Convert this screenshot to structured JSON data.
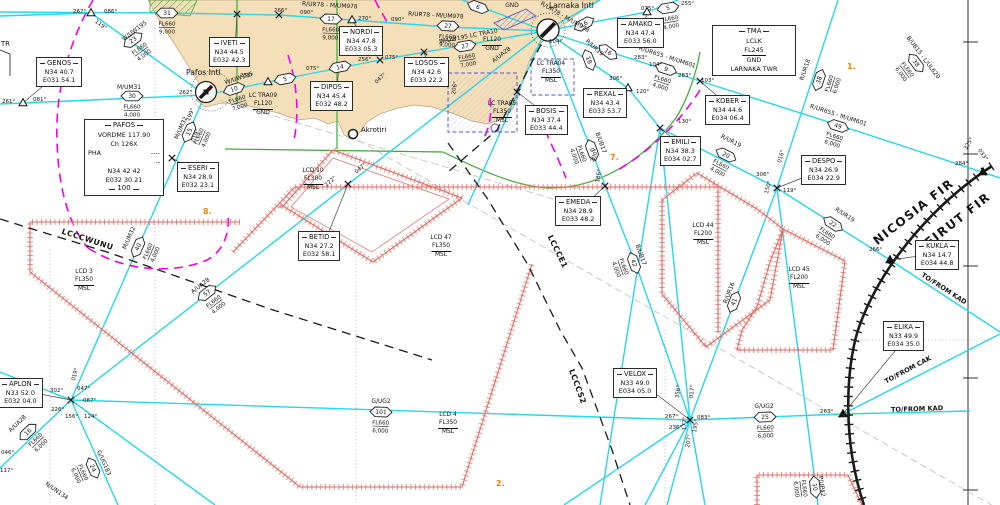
{
  "colors": {
    "cyan": "#27d7e8",
    "land": "#f4dfb9",
    "green": "#3aaa35",
    "red": "#e87c74",
    "magenta": "#f000f0",
    "blue": "#5555cc",
    "orange": "#f5820a",
    "black": "#1a1a1a"
  },
  "fir": [
    {
      "t": "NICOSIA  FIR",
      "x": 916,
      "y": 215,
      "r": -38
    },
    {
      "t": "BEIRUT  FIR",
      "x": 956,
      "y": 226,
      "r": -38
    }
  ],
  "airports": {
    "larnaka": {
      "label": "Larnaka Intl"
    },
    "pafos": {
      "label": "Pafos Intl"
    }
  },
  "town": {
    "label": "Akrotiri"
  },
  "partial_label": "TR",
  "notes": [
    {
      "t": "1.",
      "x": 847,
      "y": 62
    },
    {
      "t": "7.",
      "x": 610,
      "y": 153
    },
    {
      "t": "8.",
      "x": 203,
      "y": 207
    },
    {
      "t": "2.",
      "x": 496,
      "y": 479
    }
  ],
  "waypoints": [
    {
      "name": "GENOS",
      "lat": "N34 40.7",
      "lon": "E031 54.1",
      "bx": 36,
      "by": 57,
      "fx": 23,
      "fy": 103,
      "sym": "tri"
    },
    {
      "name": "IVETI",
      "lat": "N34 44.5",
      "lon": "E032 42.3",
      "bx": 209,
      "by": 37,
      "fx": 237,
      "fy": 14,
      "sym": "x"
    },
    {
      "name": "NORDI",
      "lat": "N34 47.8",
      "lon": "E033 05.3",
      "bx": 339,
      "by": 26,
      "fx": 352,
      "fy": 20,
      "sym": "tri"
    },
    {
      "name": "LOSOS",
      "lat": "N34 42.6",
      "lon": "E033 22.2",
      "bx": 404,
      "by": 57,
      "fx": 424,
      "fy": 52,
      "sym": "x"
    },
    {
      "name": "DIPOS",
      "lat": "N34 45.4",
      "lon": "E032 48.2",
      "bx": 310,
      "by": 81,
      "fx": 339,
      "fy": 68,
      "sym": "x"
    },
    {
      "name": "AMAKO",
      "lat": "N34 47.4",
      "lon": "E033 56.0",
      "bx": 617,
      "by": 18,
      "fx": 647,
      "fy": 12,
      "sym": "tri"
    },
    {
      "name": "REXAL",
      "lat": "N34 43.4",
      "lon": "E033 53.7",
      "bx": 583,
      "by": 88,
      "fx": 628,
      "fy": 88,
      "sym": "tri"
    },
    {
      "name": "BOSIS",
      "lat": "N34 37.4",
      "lon": "E033 44.4",
      "bx": 525,
      "by": 105,
      "fx": 517,
      "fy": 92,
      "sym": "x"
    },
    {
      "name": "KOBER",
      "lat": "N34 44.6",
      "lon": "E034 06.4",
      "bx": 705,
      "by": 95,
      "fx": 700,
      "fy": 81,
      "sym": "x"
    },
    {
      "name": "EMILI",
      "lat": "N34 38.3",
      "lon": "E034 02.7",
      "bx": 660,
      "by": 136,
      "fx": 660,
      "fy": 128,
      "sym": "x"
    },
    {
      "name": "DESPO",
      "lat": "N34 26.9",
      "lon": "E034 22.9",
      "bx": 801,
      "by": 155,
      "fx": 777,
      "fy": 188,
      "sym": "x"
    },
    {
      "name": "EMEDA",
      "lat": "N34 28.9",
      "lon": "E033 48.2",
      "bx": 555,
      "by": 196,
      "fx": 605,
      "fy": 186,
      "sym": "x"
    },
    {
      "name": "KUKLA",
      "lat": "N34 14.7",
      "lon": "E034 44.8",
      "bx": 915,
      "by": 240,
      "fx": 890,
      "fy": 260,
      "sym": "ftri"
    },
    {
      "name": "ELIKA",
      "lat": "N33 49.9",
      "lon": "E034 35.0",
      "bx": 883,
      "by": 321,
      "fx": 843,
      "fy": 414,
      "sym": "ftri"
    },
    {
      "name": "ESERI",
      "lat": "N34 28.9",
      "lon": "E032 23.1",
      "bx": 177,
      "by": 162,
      "fx": 172,
      "fy": 158,
      "sym": "x"
    },
    {
      "name": "BETID",
      "lat": "N34 27.2",
      "lon": "E032 58.1",
      "bx": 298,
      "by": 231,
      "fx": 348,
      "fy": 184,
      "sym": "x"
    },
    {
      "name": "APLON",
      "lat": "N33 52.0",
      "lon": "E032 04.0",
      "bx": -2,
      "by": 378,
      "fx": 71,
      "fy": 400,
      "sym": "x"
    },
    {
      "name": "VELOX",
      "lat": "N33 49.0",
      "lon": "E034 05.0",
      "bx": 613,
      "by": 368,
      "fx": 690,
      "fy": 420,
      "sym": "x"
    },
    {
      "name": "S",
      "lat": "1.6",
      "lon": "8.7",
      "bx": -34,
      "by": 477,
      "fx": null,
      "fy": null,
      "sym": "none"
    }
  ],
  "extra_fixes": [
    {
      "t": "tri",
      "x": 268,
      "y": 82
    },
    {
      "t": "x",
      "x": 380,
      "y": 60
    },
    {
      "t": "x",
      "x": 279,
      "y": 15
    },
    {
      "t": "tri",
      "x": 91,
      "y": 13
    },
    {
      "t": "ftri",
      "x": 983,
      "y": 172
    }
  ],
  "navaid_box": {
    "title": "PAFOS",
    "type_freq": "VORDME  117.90",
    "channel": "Ch        126X",
    "ident": "PHA",
    "morse1": "----",
    "morse2": "--",
    "coord_lat": "N34 42 42",
    "coord_lon": "E032 30 21",
    "note": "100"
  },
  "tma_box": {
    "title": "TMA",
    "ident": "LCLK",
    "level": "FL245",
    "base": "GND",
    "unit": "LARNAKA TWR"
  },
  "area_labels": [
    {
      "id": "LCD 3",
      "fl": "FL350",
      "base": "MSL",
      "x": 84,
      "y": 269
    },
    {
      "id": "LCD 10",
      "fl": "FL300",
      "base": "MSL",
      "x": 313,
      "y": 168
    },
    {
      "id": "LCD 47",
      "fl": "FL350",
      "base": "MSL",
      "x": 441,
      "y": 235
    },
    {
      "id": "LCD 4",
      "fl": "FL350",
      "base": "MSL",
      "x": 448,
      "y": 412
    },
    {
      "id": "LCD 44",
      "fl": "FL200",
      "base": "MSL",
      "x": 703,
      "y": 223
    },
    {
      "id": "LCD 45",
      "fl": "FL200",
      "base": "MSL",
      "x": 799,
      "y": 267
    },
    {
      "id": "LC TRA04",
      "fl": "FL350",
      "base": "MSL",
      "x": 551,
      "y": 61
    },
    {
      "id": "LC TRA05",
      "fl": "FL350",
      "base": "MSL",
      "x": 502,
      "y": 101
    },
    {
      "id": "LC TRA09",
      "fl": "FL120",
      "base": "GND",
      "x": 263,
      "y": 93
    },
    {
      "id": "",
      "fl": "FL120",
      "base": "GND",
      "x": 492,
      "y": 37
    }
  ],
  "badge_fl_top": "FL660",
  "badges": [
    {
      "n": "31",
      "x": 167,
      "y": 13,
      "r": 0,
      "fl": "9,000"
    },
    {
      "n": "17",
      "x": 331,
      "y": 19,
      "r": 2,
      "fl": "9,000"
    },
    {
      "n": "27",
      "x": 448,
      "y": 26,
      "r": 3,
      "fl": "9,000"
    },
    {
      "n": "27",
      "x": 465,
      "y": 46,
      "r": -10,
      "fl": "7,000"
    },
    {
      "n": "6",
      "x": 478,
      "y": 7,
      "r": 20,
      "fl": null
    },
    {
      "n": "23",
      "x": 133,
      "y": 40,
      "r": -36,
      "fl": "4,000"
    },
    {
      "n": "30",
      "x": 132,
      "y": 96,
      "r": 0,
      "fl": "4,000"
    },
    {
      "n": "10",
      "x": 234,
      "y": 89,
      "r": -18,
      "fl": "7,000"
    },
    {
      "n": "5",
      "x": 285,
      "y": 79,
      "r": -11,
      "fl": null
    },
    {
      "n": "14",
      "x": 340,
      "y": 67,
      "r": -11,
      "fl": null
    },
    {
      "n": "15",
      "x": 189,
      "y": 132,
      "r": -66,
      "fl": "4,000"
    },
    {
      "n": "40",
      "x": 138,
      "y": 247,
      "r": -66,
      "fl": "4,000"
    },
    {
      "n": "57",
      "x": 207,
      "y": 293,
      "r": -38,
      "fl": "4,000"
    },
    {
      "n": "16",
      "x": 28,
      "y": 432,
      "r": -44,
      "fl": "6,000"
    },
    {
      "n": "24",
      "x": 93,
      "y": 468,
      "r": 66,
      "fl": "6,000"
    },
    {
      "n": "101",
      "x": 381,
      "y": 412,
      "r": 2,
      "fl": "6,000"
    },
    {
      "n": "25",
      "x": 765,
      "y": 417,
      "r": -2,
      "fl": "6,000"
    },
    {
      "n": "5",
      "x": 668,
      "y": 8,
      "r": -10,
      "fl": "4,000"
    },
    {
      "n": "16",
      "x": 584,
      "y": 24,
      "r": -29,
      "fl": null
    },
    {
      "n": "16",
      "x": 608,
      "y": 52,
      "r": 36,
      "fl": null
    },
    {
      "n": "18",
      "x": 589,
      "y": 60,
      "r": 69,
      "fl": null
    },
    {
      "n": "9",
      "x": 666,
      "y": 69,
      "r": 18,
      "fl": "4,000"
    },
    {
      "n": "49",
      "x": 838,
      "y": 126,
      "r": 18,
      "fl": "6,000"
    },
    {
      "n": "38",
      "x": 819,
      "y": 80,
      "r": -72,
      "fl": "6,000"
    },
    {
      "n": "38",
      "x": 916,
      "y": 63,
      "r": 53,
      "fl": "6,000"
    },
    {
      "n": "20",
      "x": 726,
      "y": 155,
      "r": 27,
      "fl": "4,000"
    },
    {
      "n": "22",
      "x": 833,
      "y": 224,
      "r": 33,
      "fl": "6,000"
    },
    {
      "n": "9",
      "x": 592,
      "y": 150,
      "r": 70,
      "fl": "4,000"
    },
    {
      "n": "42",
      "x": 634,
      "y": 263,
      "r": 70,
      "fl": "4,000"
    },
    {
      "n": "41",
      "x": 734,
      "y": 302,
      "r": -69,
      "fl": null
    },
    {
      "n": "10",
      "x": 815,
      "y": 487,
      "r": 83,
      "fl": "6,000"
    }
  ],
  "angles": [
    {
      "t": "267°",
      "x": 73,
      "y": 9,
      "r": 0
    },
    {
      "t": "086°",
      "x": 104,
      "y": 9,
      "r": 0
    },
    {
      "t": "119°",
      "x": 97,
      "y": 19,
      "r": 36
    },
    {
      "t": "261°",
      "x": 2,
      "y": 99,
      "r": 0
    },
    {
      "t": "081°",
      "x": 33,
      "y": 97,
      "r": 0
    },
    {
      "t": "262°",
      "x": 179,
      "y": 90,
      "r": 0
    },
    {
      "t": "255°",
      "x": 240,
      "y": 73,
      "r": 0
    },
    {
      "t": "075°",
      "x": 306,
      "y": 66,
      "r": 0
    },
    {
      "t": "256°",
      "x": 358,
      "y": 57,
      "r": 0
    },
    {
      "t": "075°",
      "x": 385,
      "y": 55,
      "r": 0
    },
    {
      "t": "266°",
      "x": 274,
      "y": 8,
      "r": 0
    },
    {
      "t": "090°",
      "x": 300,
      "y": 10,
      "r": 0
    },
    {
      "t": "270°",
      "x": 358,
      "y": 16,
      "r": 0
    },
    {
      "t": "090°",
      "x": 391,
      "y": 17,
      "r": 0
    },
    {
      "t": "104°",
      "x": 549,
      "y": 39,
      "r": 0
    },
    {
      "t": "075°",
      "x": 641,
      "y": 6,
      "r": 0
    },
    {
      "t": "255°",
      "x": 681,
      "y": 1,
      "r": 0
    },
    {
      "t": "283°",
      "x": 634,
      "y": 55,
      "r": 0
    },
    {
      "t": "104°",
      "x": 649,
      "y": 62,
      "r": 0
    },
    {
      "t": "283°",
      "x": 678,
      "y": 73,
      "r": 0
    },
    {
      "t": "103°",
      "x": 701,
      "y": 78,
      "r": 0
    },
    {
      "t": "306°",
      "x": 609,
      "y": 76,
      "r": 0
    },
    {
      "t": "120°",
      "x": 636,
      "y": 89,
      "r": 0
    },
    {
      "t": "130°",
      "x": 678,
      "y": 119,
      "r": 0
    },
    {
      "t": "306°",
      "x": 756,
      "y": 172,
      "r": 0
    },
    {
      "t": "016°",
      "x": 777,
      "y": 162,
      "r": -74
    },
    {
      "t": "150°",
      "x": 764,
      "y": 193,
      "r": -74
    },
    {
      "t": "119°",
      "x": 783,
      "y": 188,
      "r": 0
    },
    {
      "t": "266°",
      "x": 869,
      "y": 247,
      "r": 0
    },
    {
      "t": "325°",
      "x": 963,
      "y": 148,
      "r": -58
    },
    {
      "t": "033°",
      "x": 981,
      "y": 148,
      "r": 55
    },
    {
      "t": "284°",
      "x": 955,
      "y": 161,
      "r": 0
    },
    {
      "t": "222°",
      "x": 324,
      "y": 184,
      "r": -42
    },
    {
      "t": "047°",
      "x": 354,
      "y": 171,
      "r": -42
    },
    {
      "t": "047°",
      "x": 374,
      "y": 81,
      "r": -42
    },
    {
      "t": "206°",
      "x": 451,
      "y": 94,
      "r": -80
    },
    {
      "t": "200°",
      "x": 590,
      "y": 161,
      "r": -70
    },
    {
      "t": "186°",
      "x": 595,
      "y": 182,
      "r": -80
    },
    {
      "t": "302°",
      "x": 50,
      "y": 388,
      "r": 0
    },
    {
      "t": "019°",
      "x": 71,
      "y": 380,
      "r": -75
    },
    {
      "t": "047°",
      "x": 77,
      "y": 386,
      "r": 0
    },
    {
      "t": "087°",
      "x": 83,
      "y": 398,
      "r": 0
    },
    {
      "t": "226°",
      "x": 51,
      "y": 407,
      "r": 0
    },
    {
      "t": "156°",
      "x": 65,
      "y": 414,
      "r": 0
    },
    {
      "t": "124°",
      "x": 84,
      "y": 414,
      "r": 0
    },
    {
      "t": "046°",
      "x": 1,
      "y": 450,
      "r": 0
    },
    {
      "t": "117°",
      "x": 0,
      "y": 468,
      "r": 0
    },
    {
      "t": "267°",
      "x": 665,
      "y": 414,
      "r": 0
    },
    {
      "t": "083°",
      "x": 697,
      "y": 415,
      "r": 0
    },
    {
      "t": "356°",
      "x": 675,
      "y": 398,
      "r": -85
    },
    {
      "t": "017°",
      "x": 689,
      "y": 398,
      "r": -85
    },
    {
      "t": "236°",
      "x": 669,
      "y": 425,
      "r": 0
    },
    {
      "t": "177°",
      "x": 682,
      "y": 430,
      "r": -87
    },
    {
      "t": "195°",
      "x": 692,
      "y": 432,
      "r": -80
    },
    {
      "t": "207°",
      "x": 685,
      "y": 447,
      "r": -80
    },
    {
      "t": "263°",
      "x": 820,
      "y": 409,
      "r": 0
    },
    {
      "t": "199°",
      "x": 186,
      "y": 120,
      "r": -70
    },
    {
      "t": "019°",
      "x": 191,
      "y": 141,
      "r": -70
    }
  ],
  "airway_labels": [
    {
      "t": "R/UR78 - M/UM978",
      "x": 330,
      "y": 3,
      "r": 3
    },
    {
      "t": "R/UR78 - M/UM978",
      "x": 436,
      "y": 13,
      "r": 3
    },
    {
      "t": "R/UR78 - M/UM978",
      "x": 566,
      "y": 15,
      "r": 30
    },
    {
      "t": "W/UW195",
      "x": 133,
      "y": 29,
      "r": -36
    },
    {
      "t": "M/UM31",
      "x": 129,
      "y": 85,
      "r": 0
    },
    {
      "t": "W/UW195 LC TRA10",
      "x": 468,
      "y": 34,
      "r": -11
    },
    {
      "t": "W/UW195",
      "x": 238,
      "y": 76,
      "r": -18
    },
    {
      "t": "M/UM32",
      "x": 179,
      "y": 127,
      "r": -66
    },
    {
      "t": "M/UM32",
      "x": 127,
      "y": 237,
      "r": -66
    },
    {
      "t": "A/UA28",
      "x": 500,
      "y": 53,
      "r": -38
    },
    {
      "t": "A/UA28",
      "x": 199,
      "y": 284,
      "r": -38
    },
    {
      "t": "A/UA28",
      "x": 16,
      "y": 422,
      "r": -44
    },
    {
      "t": "G/UG183",
      "x": 106,
      "y": 462,
      "r": 66
    },
    {
      "t": "N/UN134",
      "x": 58,
      "y": 489,
      "r": 35
    },
    {
      "t": "G/UG2",
      "x": 381,
      "y": 399,
      "r": 0
    },
    {
      "t": "G/UG2",
      "x": 764,
      "y": 404,
      "r": 0
    },
    {
      "t": "P/UP42",
      "x": 824,
      "y": 486,
      "r": 83
    },
    {
      "t": "R/UR655 - M/UM601",
      "x": 668,
      "y": 55,
      "r": 18
    },
    {
      "t": "R/UR655 - M/UM601",
      "x": 839,
      "y": 113,
      "r": 18
    },
    {
      "t": "R/UR18",
      "x": 803,
      "y": 69,
      "r": -72
    },
    {
      "t": "B/UB15 - L/UL620",
      "x": 925,
      "y": 56,
      "r": 53
    },
    {
      "t": "R/UR19",
      "x": 596,
      "y": 46,
      "r": 42
    },
    {
      "t": "R/UR19",
      "x": 732,
      "y": 139,
      "r": 27
    },
    {
      "t": "R/UR19",
      "x": 846,
      "y": 213,
      "r": 33
    },
    {
      "t": "B/UB17",
      "x": 603,
      "y": 142,
      "r": 70
    },
    {
      "t": "B/UB17",
      "x": 643,
      "y": 254,
      "r": 70
    },
    {
      "t": "R/UR16",
      "x": 727,
      "y": 292,
      "r": -69
    },
    {
      "t": "GND",
      "x": 512,
      "y": 3,
      "r": 0
    }
  ],
  "boundary_labels": [
    {
      "t": "LCCCWUNU",
      "x": 88,
      "y": 238,
      "r": 18
    },
    {
      "t": "LCCCE1",
      "x": 559,
      "y": 251,
      "r": 64
    },
    {
      "t": "LCCCS2",
      "x": 579,
      "y": 386,
      "r": 70
    }
  ],
  "route_labels": [
    {
      "t": "TO/FROM CAK",
      "x": 907,
      "y": 368,
      "r": -28
    },
    {
      "t": "TO/FROM KAD",
      "x": 917,
      "y": 407,
      "r": -2
    },
    {
      "t": "TO/FROM KAD",
      "x": 945,
      "y": 287,
      "r": 33
    }
  ]
}
